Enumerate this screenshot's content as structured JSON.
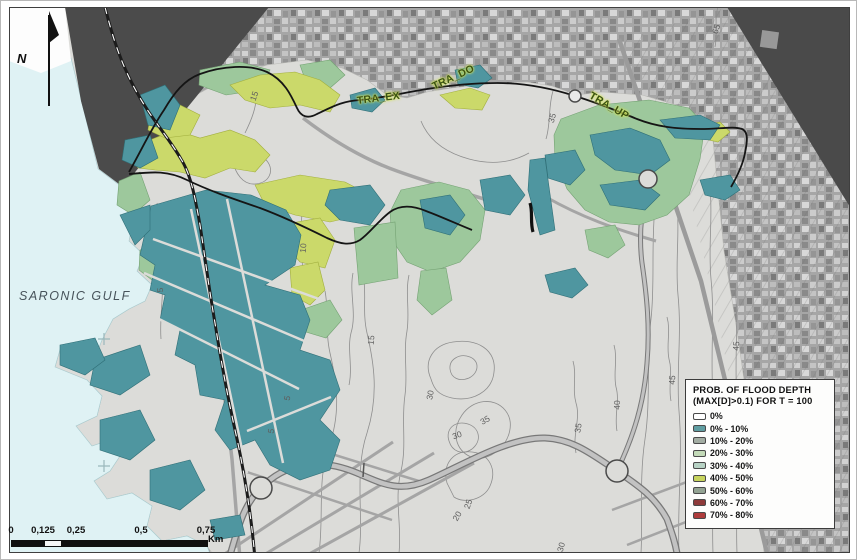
{
  "map": {
    "region_label": "SARONIC GULF",
    "north_label": "N",
    "transects": [
      {
        "label": "TRA_EX",
        "x": 356,
        "y": 94,
        "angle": -7
      },
      {
        "label": "TRA_DO",
        "x": 432,
        "y": 80,
        "angle": -25
      },
      {
        "label": "TRA_UP",
        "x": 589,
        "y": 88,
        "angle": 30
      }
    ],
    "contour_labels": [
      {
        "text": "5",
        "x": 159,
        "y": 289,
        "angle": -90
      },
      {
        "text": "5",
        "x": 286,
        "y": 397,
        "angle": -78
      },
      {
        "text": "5",
        "x": 270,
        "y": 430,
        "angle": -80
      },
      {
        "text": "10",
        "x": 302,
        "y": 247,
        "angle": -85
      },
      {
        "text": "15",
        "x": 370,
        "y": 339,
        "angle": -85
      },
      {
        "text": "15",
        "x": 253,
        "y": 95,
        "angle": -70
      },
      {
        "text": "20",
        "x": 456,
        "y": 515,
        "angle": -60
      },
      {
        "text": "25",
        "x": 467,
        "y": 503,
        "angle": -70
      },
      {
        "text": "30",
        "x": 429,
        "y": 394,
        "angle": -80
      },
      {
        "text": "30",
        "x": 456,
        "y": 434,
        "angle": -20
      },
      {
        "text": "30",
        "x": 560,
        "y": 546,
        "angle": -75
      },
      {
        "text": "35",
        "x": 484,
        "y": 419,
        "angle": -30
      },
      {
        "text": "35",
        "x": 577,
        "y": 427,
        "angle": -82
      },
      {
        "text": "35",
        "x": 551,
        "y": 117,
        "angle": -75
      },
      {
        "text": "40",
        "x": 616,
        "y": 404,
        "angle": -90
      },
      {
        "text": "45",
        "x": 671,
        "y": 379,
        "angle": -86
      },
      {
        "text": "45",
        "x": 735,
        "y": 345,
        "angle": -86
      },
      {
        "text": "65",
        "x": 715,
        "y": 28,
        "angle": -70
      }
    ]
  },
  "legend": {
    "title_line1": "PROB. OF FLOOD DEPTH",
    "title_line2": "(MAX[D]>0.1) FOR T = 100",
    "items": [
      {
        "label": "0%",
        "color": "#ffffff"
      },
      {
        "label": "0% - 10%",
        "color": "#5f9da1"
      },
      {
        "label": "10% - 20%",
        "color": "#a3ada3"
      },
      {
        "label": "20% - 30%",
        "color": "#c3dab8"
      },
      {
        "label": "30% - 40%",
        "color": "#b7d2c4"
      },
      {
        "label": "40% - 50%",
        "color": "#c7d45d"
      },
      {
        "label": "50% - 60%",
        "color": "#93a393"
      },
      {
        "label": "60% - 70%",
        "color": "#8e3a3a"
      },
      {
        "label": "70% - 80%",
        "color": "#ae3c3c"
      }
    ]
  },
  "scalebar": {
    "ticks": [
      {
        "label": "0",
        "x": 10
      },
      {
        "label": "0,125",
        "x": 42
      },
      {
        "label": "0,25",
        "x": 75
      },
      {
        "label": "0,5",
        "x": 140
      },
      {
        "label": "0,75",
        "x": 205
      }
    ],
    "unit": "Km"
  },
  "map_colors": {
    "water": "#dff2f4",
    "land": "#dcdcd9",
    "outside_area": "#4b4b4b",
    "flood_teal": "#4f96a0",
    "flood_green": "#9dc89c",
    "flood_yellow": "#cbd96a"
  }
}
